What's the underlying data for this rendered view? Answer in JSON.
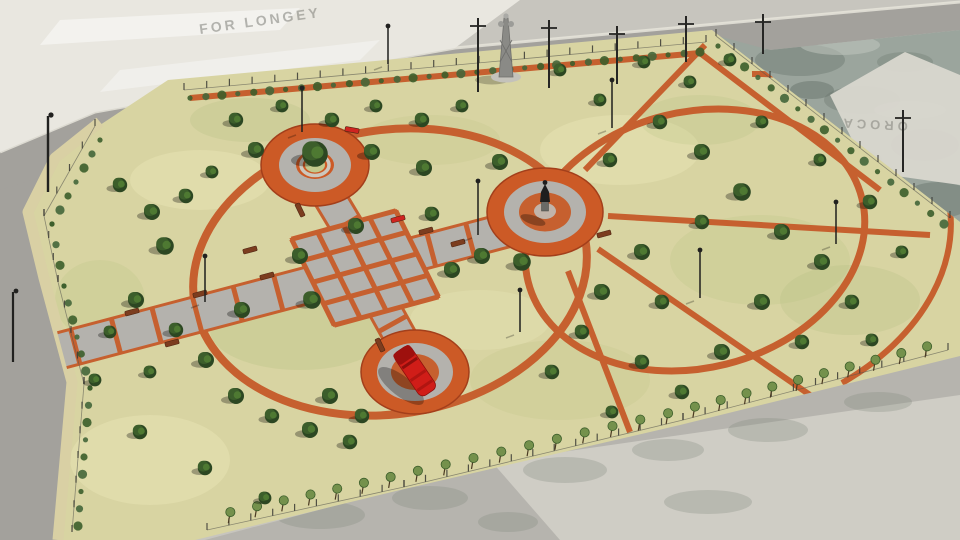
{
  "image": {
    "description": "Aerial 3D architectural rendering of a proposed rectangular public park with circular orange jogging paths, a checkered cross walkway, three circular plazas and perimeter planting",
    "view": "isometric aerial render"
  },
  "watermarks": {
    "top_left": "FOR LONGEY",
    "right_pad": "OROCA"
  },
  "palette": {
    "ground": "#c7c5be",
    "pad": "#e9e7e0",
    "pad_right": "#d9d7cf",
    "road": "#a3a19c",
    "road_curb": "#e6e4db",
    "lot": "#9ba59d",
    "lot_blotch": "#67746b",
    "lot_light": "#c3cac2",
    "bottom_concrete": "#b6b4ae",
    "bottom_pad": "#cfcdc5",
    "concrete_blotch": "#7e847b",
    "grass": "#d8d4a2",
    "grass_dark": "#c2c88c",
    "grass_light": "#e7e3b4",
    "grass_green": "#aebd7e",
    "path_orange": "#c6602f",
    "ring_orange": "#cc5a26",
    "ring_rim": "#a33f1b",
    "walkway": "#b4b2ad",
    "walkway_light": "#c0beb8",
    "curb_stone": "#d9d0a4",
    "tree_dark": "#2c4722",
    "tree_mid": "#3c5e2b",
    "tree_light": "#507c33",
    "sapling": "#74914c",
    "hedge": "#44663a",
    "trunk": "#4a3a22",
    "truck_red": "#d01d18",
    "truck_red_dark": "#9e100d",
    "bench_brown": "#7c3d1f",
    "bench_red": "#cf2420",
    "fence": "#3a3a34",
    "pole": "#21211f",
    "statue": "#1e1e1e",
    "pedestal": "#6a6a66",
    "bench_ring": "#ccc7bd",
    "shadow": "#000000"
  },
  "features": {
    "plazas": [
      {
        "name": "tree-court-plaza",
        "position": "north-west",
        "elements": "orange ring, gray ring, circular bench around central tree"
      },
      {
        "name": "statue-plaza",
        "position": "center",
        "elements": "orange ring, gray ring, orange disc, dark statue on pedestal"
      },
      {
        "name": "firetruck-plaza",
        "position": "south",
        "elements": "orange ring, gray ring, orange disc, red fire truck monument"
      }
    ],
    "circulation": "gray cross walkways with orange banding and checkered intersection; two concentric orange jogging loops with radial spokes; orange path along north boundary",
    "planting": "dense shrub trees along paths, hedge rows inside fence, sapling row along south fence, dry yellow-green lawn",
    "surroundings": "asphalt roads on north and west sides, white concrete pads, mottled vacant lot at north-east, utility poles, street lights, lattice tower"
  }
}
